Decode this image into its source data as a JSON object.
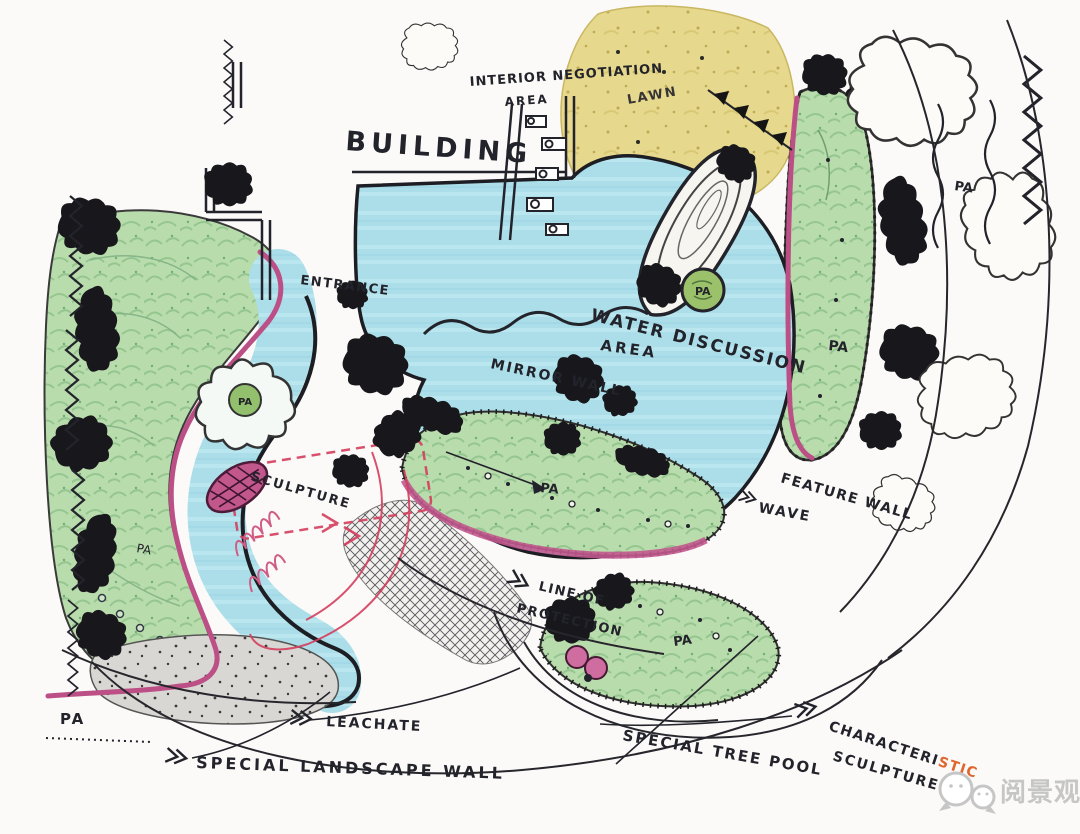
{
  "title": "Hand-drawn landscape concept plan sketch",
  "labels": {
    "building": "BUILDING",
    "interior_negotiation": "INTERIOR NEGOTIATION",
    "interior_negotiation_area": "AREA",
    "lawn": "LAWN",
    "entrance": "ENTRANCE",
    "water_discussion": "WATER DISCUSSION",
    "water_discussion_area": "AREA",
    "mirror_wall": "MIRROR WALL",
    "sculpture_left": "SCULPTURE",
    "feature_wall": "FEATURE WALL",
    "wave": "WAVE",
    "line_of": "LINE OF",
    "protection": "PROTECTION",
    "leachate": "LEACHATE",
    "special_landscape_wall": "SPECIAL LANDSCAPE WALL",
    "special_tree_pool": "SPECIAL TREE POOL",
    "characteristic_prefix": "CHARACTERI",
    "characteristic_suffix": "STIC",
    "sculpture_right": "SCULPTURE",
    "pa": "PA"
  },
  "watermark": {
    "logo": "wechat-logo",
    "text": "阅景观"
  },
  "colors": {
    "ink": "#23232b",
    "water_blue": "#abdee9",
    "lawn_yellow": "#e6d88c",
    "planting_green": "#b9dcac",
    "wall_pink": "#bc4f86",
    "marker_red": "#d43f5e",
    "highlight_orange": "#e0662e",
    "concrete_gray": "#d8d7d3",
    "paper": "#fbfaf8"
  }
}
